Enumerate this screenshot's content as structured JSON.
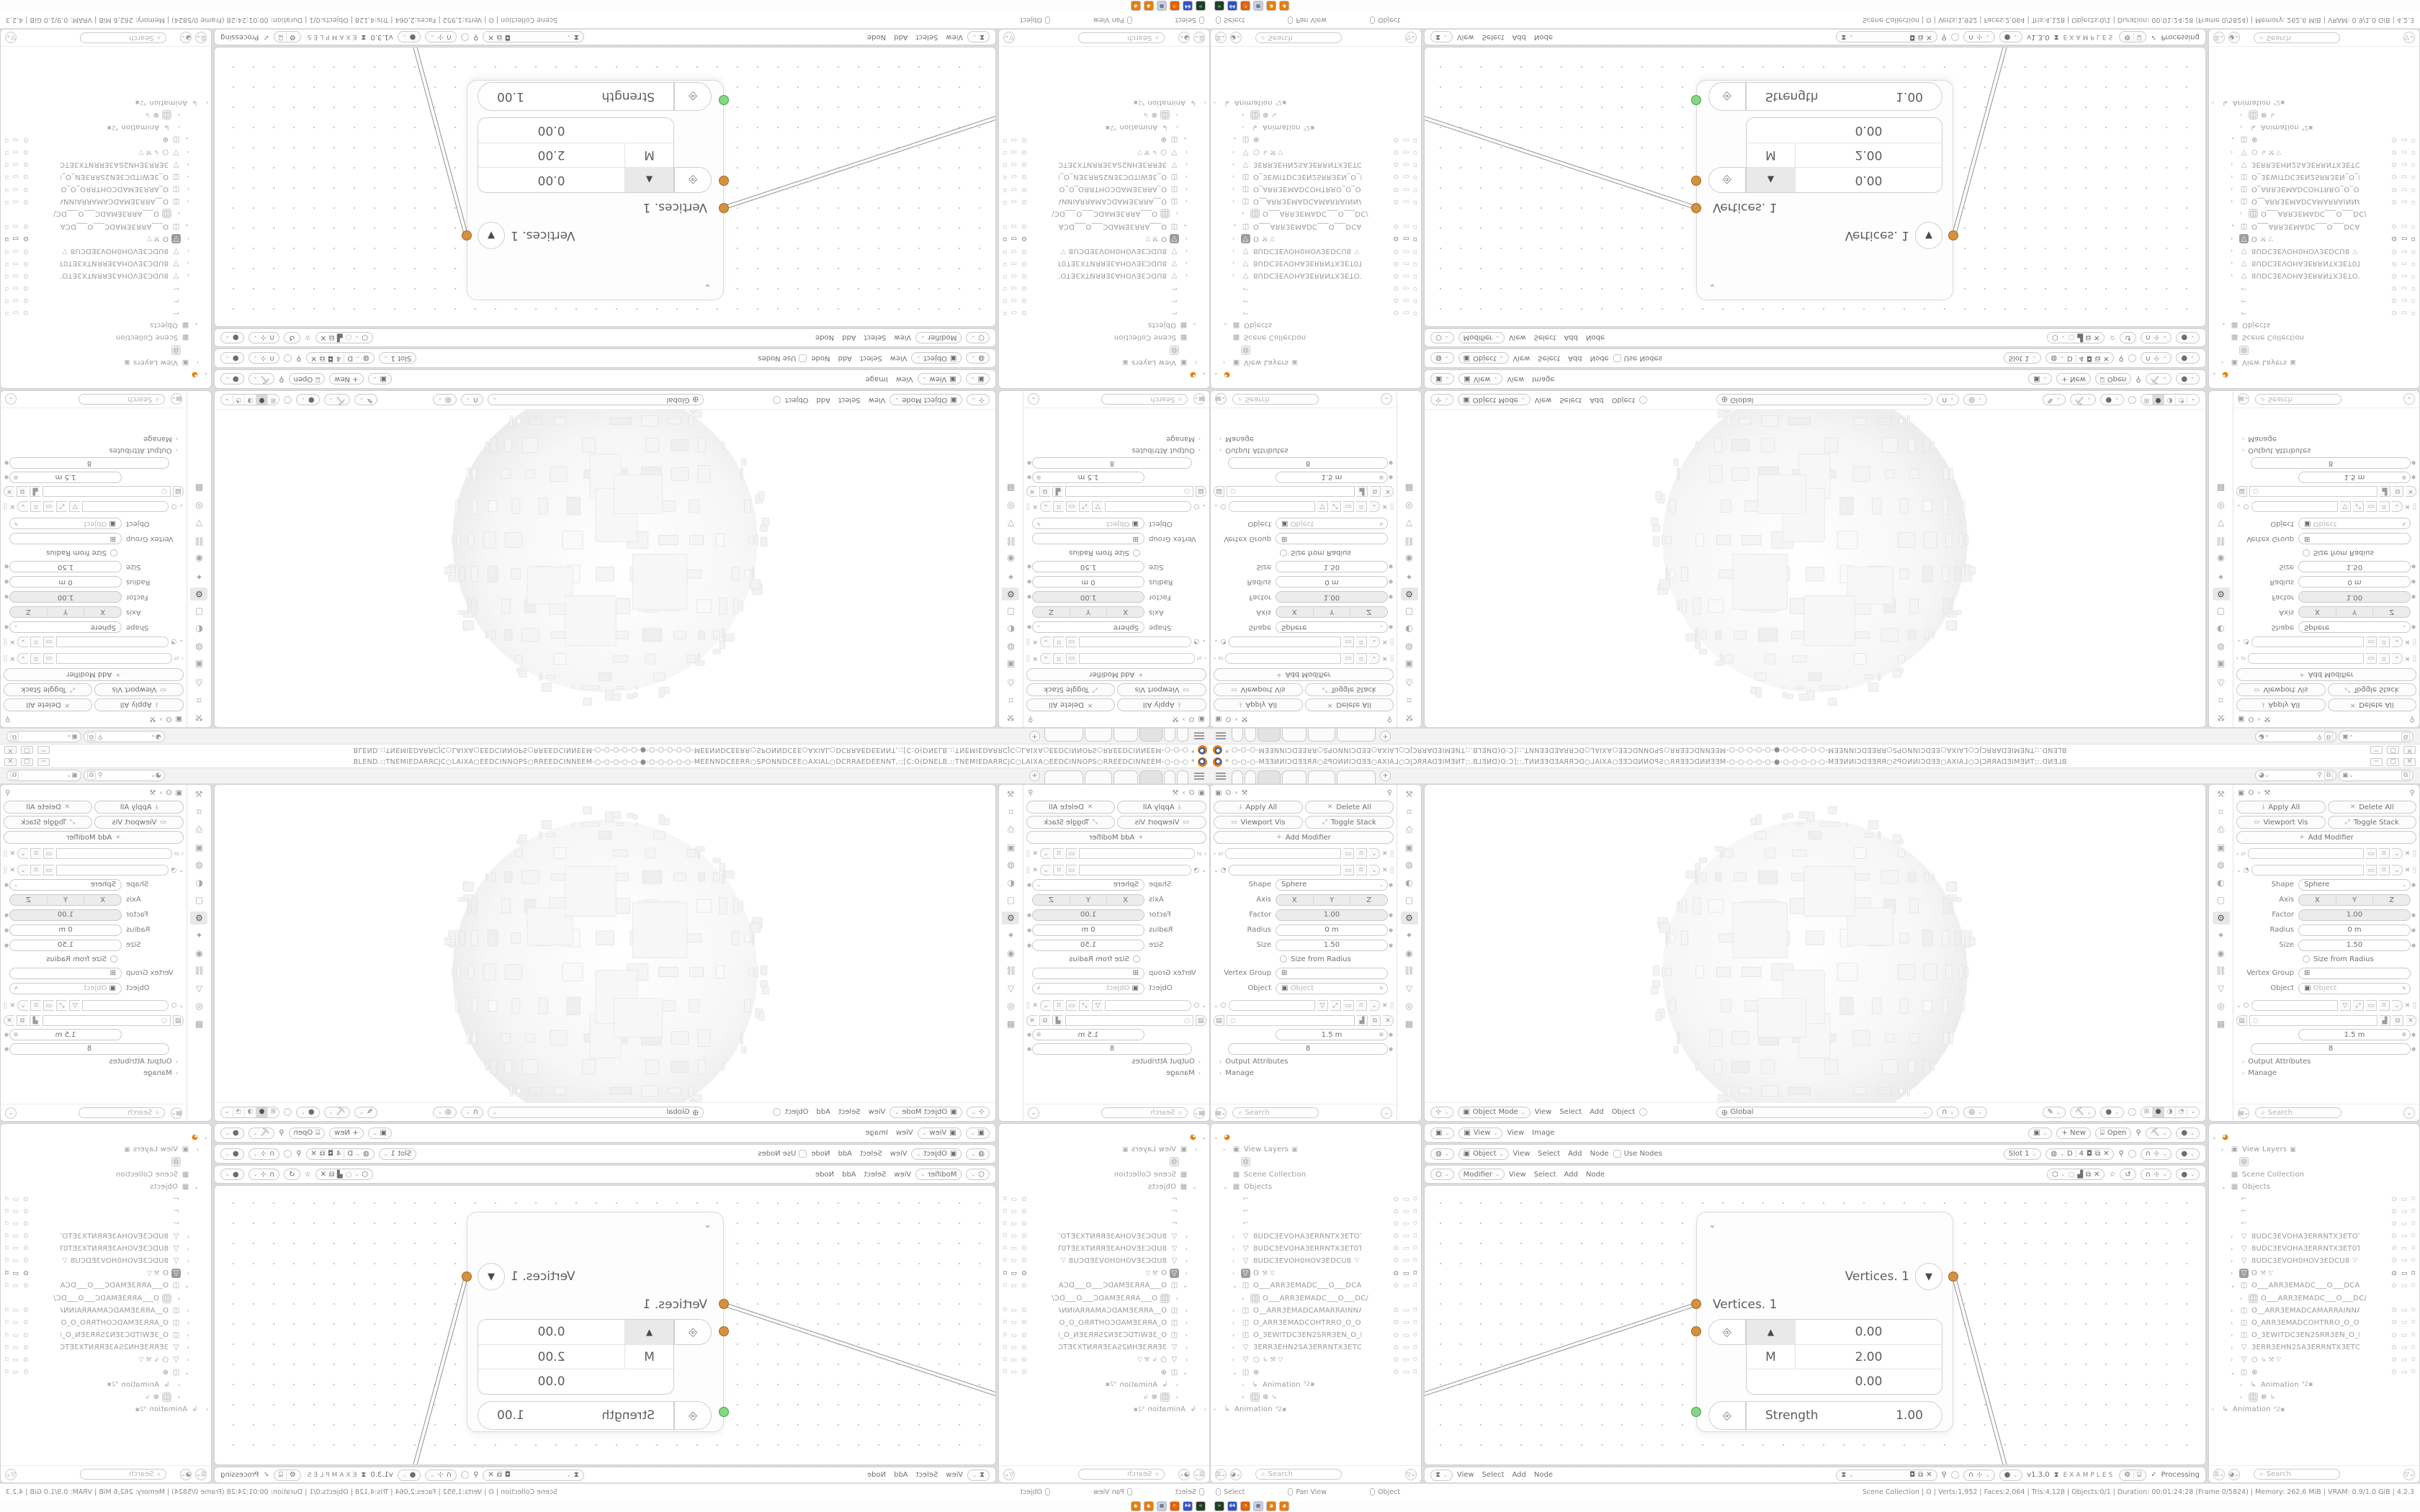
{
  "window": {
    "title": "BLEND.:;TNEMIEDARRCJC○LAIXA○EEDCINNOPS○RREEDCINNEEM-○-○-○-○-○-●-○-○-○-○-○-MEENNDCEERR○SPONNDCEE○AXIAL○DCRRAEDEENNT,:;[C:O(DNELB.:;TNEMIEDARRCJC○LAIXA○EEDCINNOPS○RREEDCINNEEM-○-○-○ *",
    "minimize": "─",
    "maximize": "▢",
    "close": "✕",
    "plus_tab": "+"
  },
  "properties": {
    "apply_all": "Apply All",
    "delete_all": "Delete All",
    "viewport_vis": "Viewport Vis",
    "toggle_stack": "Toggle Stack",
    "add_modifier": "Add Modifier",
    "shape_label": "Shape",
    "shape_value": "Sphere",
    "axis_label": "Axis",
    "axis_x": "X",
    "axis_y": "Y",
    "axis_z": "Z",
    "factor_label": "Factor",
    "factor_value": "1.00",
    "radius_label": "Radius",
    "radius_value": "0 m",
    "size_label": "Size",
    "size_value": "1.50",
    "size_from_radius": "Size from Radius",
    "vertex_group_label": "Vertex Group",
    "object_label": "Object",
    "object_placeholder": "Object",
    "scale_value": "1.5 m",
    "count_value": "8",
    "output_attributes": "Output Attributes",
    "manage": "Manage",
    "search_placeholder": "Search",
    "breadcrumb_obj": "O"
  },
  "viewport_header": {
    "mode": "Object Mode",
    "m_view": "View",
    "m_select": "Select",
    "m_add": "Add",
    "m_object": "Object",
    "orientation": "Global"
  },
  "image_header": {
    "selector": "View",
    "m_view": "View",
    "m_image": "Image",
    "new_btn": "+ New",
    "open_btn": "Open"
  },
  "shader_header": {
    "selector": "Object",
    "m_view": "View",
    "m_select": "Select",
    "m_add": "Add",
    "m_node": "Node",
    "use_nodes": "Use Nodes",
    "slot": "Slot 1",
    "mat": "D",
    "users": "4"
  },
  "geo_header": {
    "selector": "Modifier",
    "m_view": "View",
    "m_select": "Select",
    "m_add": "Add",
    "m_node": "Node"
  },
  "bottom_header": {
    "m_view": "View",
    "m_select": "Select",
    "m_add": "Add",
    "m_node": "Node",
    "version": "v1.3.0",
    "examples": "EXAMPLES",
    "check": "✓",
    "processing": "Processing"
  },
  "node": {
    "out_label": "Vertices. 1",
    "in_label": "Vertices. 1",
    "vec_x": "0.00",
    "vec_y": "2.00",
    "vec_z": "0.00",
    "m_label": "M",
    "strength_label": "Strength",
    "strength_value": "1.00"
  },
  "outliner": {
    "search_placeholder": "Search",
    "rows": [
      {
        "ind": 0,
        "arr": "⌄",
        "icon": "logo",
        "label": "",
        "tg": ""
      },
      {
        "ind": 1,
        "arr": "›",
        "icon": "img",
        "label": "View Layers",
        "xtra": "▣",
        "tg": ""
      },
      {
        "ind": 2,
        "arr": "",
        "icon": "globe",
        "label": "",
        "tg": ""
      },
      {
        "ind": 1,
        "arr": "",
        "icon": "coll",
        "label": "Scene Collection",
        "tg": ""
      },
      {
        "ind": 1,
        "arr": "⌄",
        "icon": "coll",
        "label": "Objects",
        "tg": ""
      },
      {
        "ind": 2,
        "arr": "",
        "icon": "hook",
        "label": "",
        "tg": "lt"
      },
      {
        "ind": 2,
        "arr": "",
        "icon": "hook",
        "label": "",
        "tg": "lt"
      },
      {
        "ind": 2,
        "arr": "",
        "icon": "hook",
        "label": "",
        "tg": "lt"
      },
      {
        "ind": 2,
        "arr": "›",
        "icon": "mesh",
        "label": "8UDC3EVOHA3ERRNTX3ETOT3EXT",
        "tg": "lt"
      },
      {
        "ind": 2,
        "arr": "›",
        "icon": "mesh",
        "label": "8UDC3EVOHA3ERRNTX3ET0T3EXT",
        "tg": "lt"
      },
      {
        "ind": 2,
        "arr": "›",
        "icon": "mesh",
        "label": "8UDC3EVOH0HOV3EDCU8",
        "xtra": "▽",
        "tg": "lt"
      },
      {
        "ind": 2,
        "arr": "›",
        "icon": "meshsel",
        "label": "O",
        "xtra": "⚒ ▽",
        "tg": "dk",
        "sel": true
      },
      {
        "ind": 2,
        "arr": "⌄",
        "icon": "cam",
        "label": "O___ARR3EMADC___O___DCAM3E",
        "tg": "lt"
      },
      {
        "ind": 3,
        "arr": "›",
        "icon": "cambox",
        "label": "O___ARR3EMADC___O___DC/",
        "tg": ""
      },
      {
        "ind": 2,
        "arr": "›",
        "icon": "cam",
        "label": "O__ARR3EMADCAMARRAINNAP__O",
        "tg": "lt"
      },
      {
        "ind": 2,
        "arr": "›",
        "icon": "cam",
        "label": "O_ARR3EMADCOHTRRO_O_ORRTH",
        "tg": "lt"
      },
      {
        "ind": 2,
        "arr": "›",
        "icon": "cam",
        "label": "O_3EWITDC3EN2SRR3EN_O_N3ERF",
        "tg": "lt"
      },
      {
        "ind": 2,
        "arr": "›",
        "icon": "mesh",
        "label": "3ERR3EHN2SA3ERRNTX3ETOT3EXT",
        "tg": "lt"
      },
      {
        "ind": 2,
        "arr": "›",
        "icon": "mesh",
        "label": "○",
        "xtra": "↳ ⚒ ▽",
        "tg": "lt"
      },
      {
        "ind": 2,
        "arr": "⌄",
        "icon": "cam",
        "label": "⊕",
        "tg": "lt"
      },
      {
        "ind": 3,
        "arr": "›",
        "icon": "anim",
        "label": "Animation",
        "xtra": "⁴2▪",
        "tg": ""
      },
      {
        "ind": 3,
        "arr": "›",
        "icon": "cambox",
        "label": "⊕",
        "xtra": "↳",
        "tg": ""
      },
      {
        "ind": 0,
        "arr": "›",
        "icon": "anim",
        "label": "Animation",
        "xtra": "⁴2▪",
        "tg": ""
      }
    ]
  },
  "statusbar": {
    "hint_select": "Select",
    "hint_pan": "Pan View",
    "hint_object": "Object",
    "stats": "Scene Collection | O | Verts:1,952 | Faces:2,064 | Tris:4,128 | Objects:0/1 | Duration: 00:01:24:28 (Frame 0/5824) | Memory: 262,6 MiB | VRAM: 0.9/1.0 GiB | 4.2.3"
  },
  "taskbar": {
    "icons": [
      {
        "name": "terminal-icon",
        "bg": "#223d2c",
        "fg": "#7fe07f",
        "label": ">"
      },
      {
        "name": "floppy64-icon",
        "bg": "#3050c8",
        "fg": "#ffffff",
        "label": "64"
      },
      {
        "name": "firefox-icon",
        "bg": "#e66000",
        "fg": "#ffd27a",
        "label": "◔"
      },
      {
        "name": "calculator-icon",
        "bg": "#c7d0e2",
        "fg": "#39425a",
        "label": "▦"
      },
      {
        "name": "blender-icon",
        "bg": "#e87d0d",
        "fg": "#ffffff",
        "label": "◕"
      },
      {
        "name": "blender-icon",
        "bg": "#e87d0d",
        "fg": "#ffffff",
        "label": "◕"
      }
    ]
  }
}
